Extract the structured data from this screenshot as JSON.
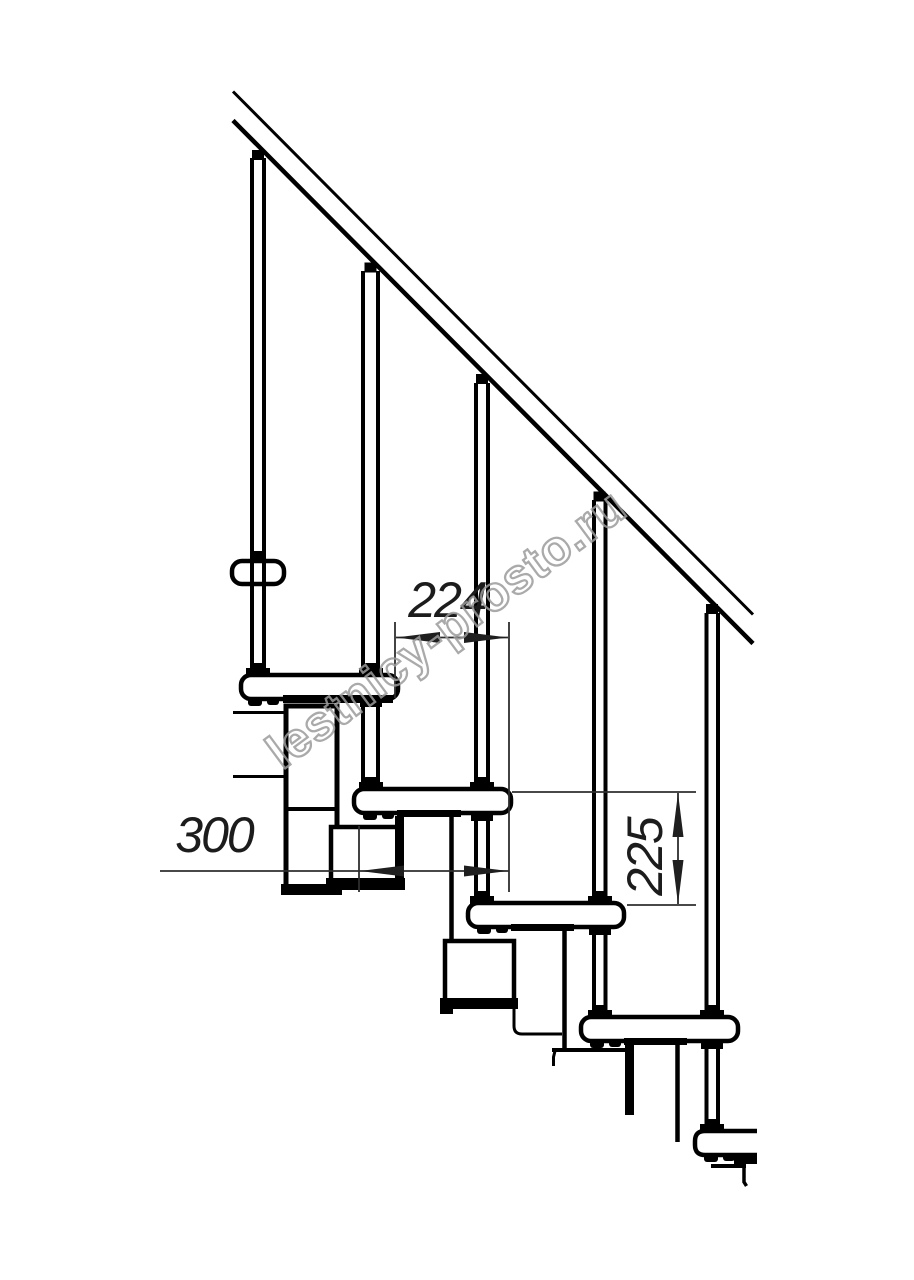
{
  "page": {
    "background": "#ffffff"
  },
  "drawing": {
    "type": "technical-line-drawing",
    "subject": "modular staircase side view fragment",
    "line_color": "#000000",
    "dimension_color": "#2e2e2e"
  },
  "dimensions": {
    "run": {
      "value": "224",
      "orientation": "horizontal"
    },
    "depth": {
      "value": "300",
      "orientation": "horizontal"
    },
    "rise": {
      "value": "225",
      "orientation": "vertical-rotated"
    }
  },
  "watermark": {
    "text": "lestnicy-prosto.ru",
    "color": "#9c9c9c"
  }
}
